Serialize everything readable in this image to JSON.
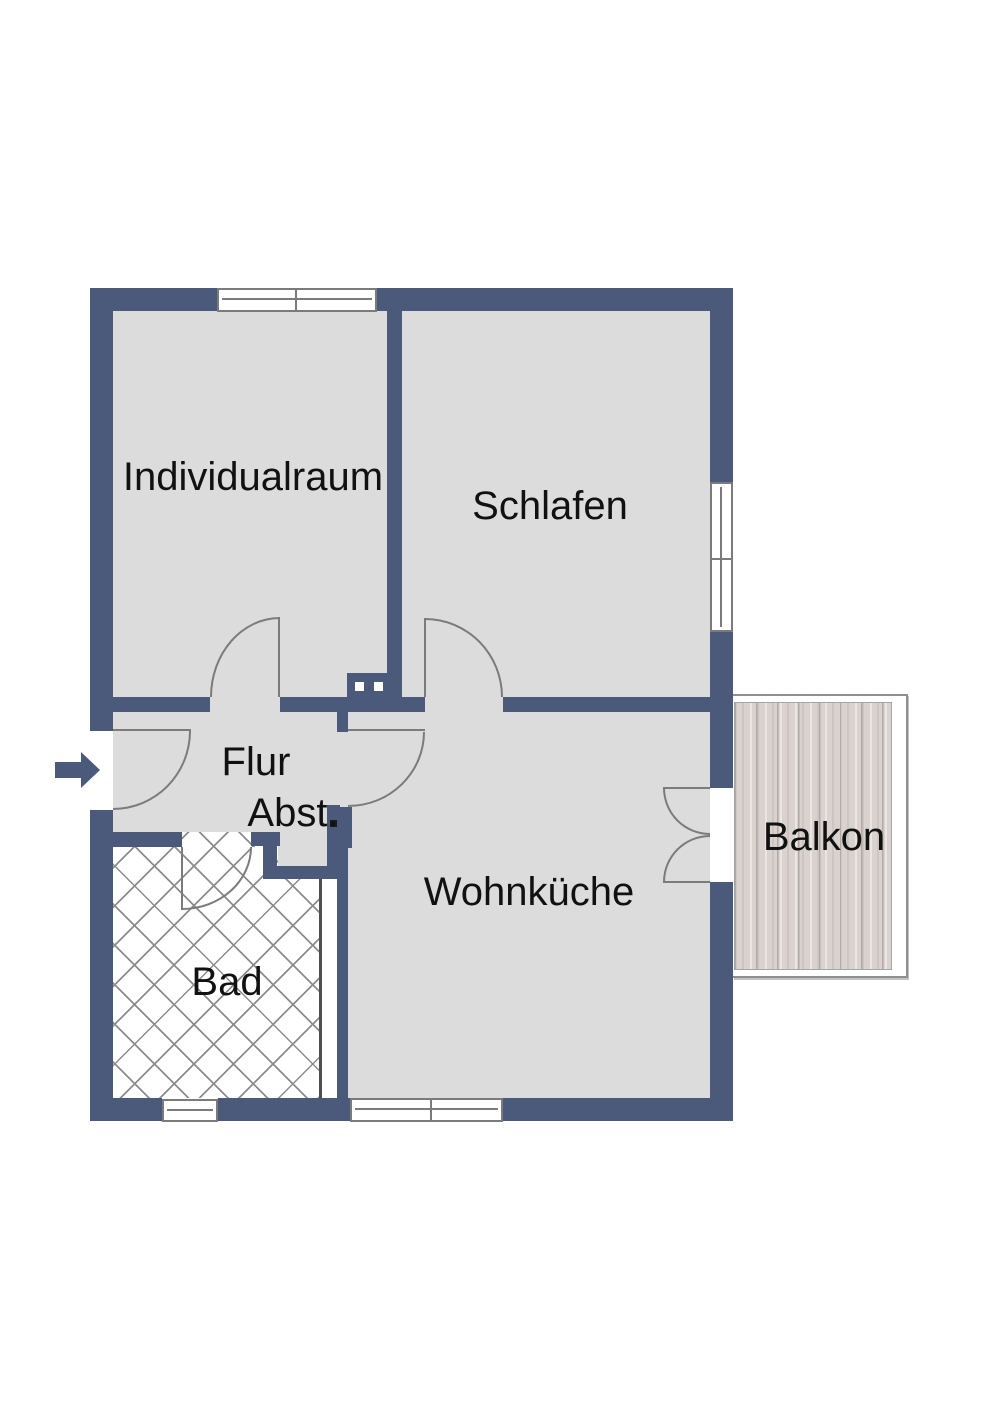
{
  "floorplan": {
    "title": "Wohnung Grundriss",
    "rooms": [
      {
        "id": "individualraum",
        "label": "Individualraum"
      },
      {
        "id": "schlafen",
        "label": "Schlafen"
      },
      {
        "id": "flur",
        "label": "Flur"
      },
      {
        "id": "abstellraum",
        "label": "Abst."
      },
      {
        "id": "bad",
        "label": "Bad"
      },
      {
        "id": "wohnkueche",
        "label": "Wohnküche"
      },
      {
        "id": "balkon",
        "label": "Balkon"
      }
    ],
    "entrance": {
      "icon": "arrow-right-icon",
      "meaning": "Eingang"
    },
    "colors": {
      "wall": "#4b5a7a",
      "floor": "#dcdcdc",
      "stroke": "#7b7b7b",
      "latline": "#8c8c8c",
      "wood": "#d9d2ce",
      "woodline": "#b2a9a6",
      "text": "#111111",
      "window": "#ffffff"
    },
    "features": {
      "windows": [
        "top-double-window",
        "right-double-window",
        "bad-window",
        "wohnkueche-double-window"
      ],
      "doors": [
        "entrance-door",
        "individualraum-door",
        "schlafen-door",
        "wohnkueche-door",
        "bad-door",
        "balcony-french-door"
      ],
      "floor_patterns": {
        "bad": "tile-lattice",
        "balkon": "wood-planks"
      }
    }
  }
}
